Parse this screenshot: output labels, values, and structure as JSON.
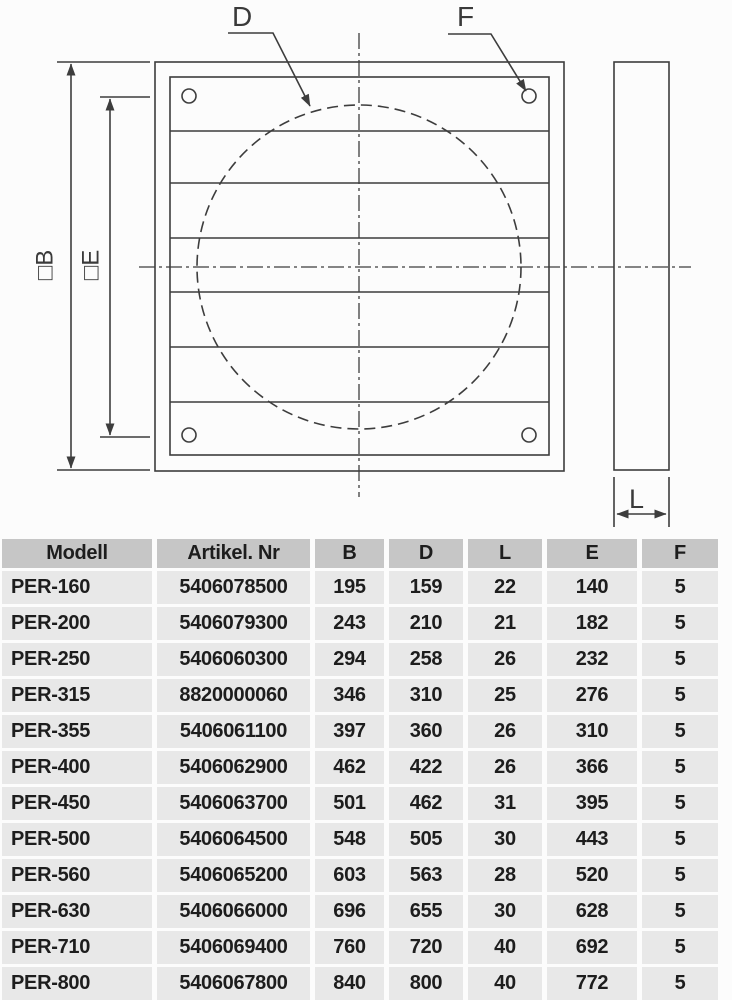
{
  "diagram": {
    "labels": {
      "d": "D",
      "f": "F",
      "l": "L",
      "b": "□B",
      "e": "□E"
    },
    "colors": {
      "line": "#3d3d3d"
    }
  },
  "table": {
    "colors": {
      "header_bg": "#c6c6c6",
      "row_bg": "#e8e8e8",
      "text": "#1d1d1d"
    },
    "columns": [
      "Modell",
      "Artikel. Nr",
      "B",
      "D",
      "L",
      "E",
      "F"
    ],
    "rows": [
      [
        "PER-160",
        "5406078500",
        "195",
        "159",
        "22",
        "140",
        "5"
      ],
      [
        "PER-200",
        "5406079300",
        "243",
        "210",
        "21",
        "182",
        "5"
      ],
      [
        "PER-250",
        "5406060300",
        "294",
        "258",
        "26",
        "232",
        "5"
      ],
      [
        "PER-315",
        "8820000060",
        "346",
        "310",
        "25",
        "276",
        "5"
      ],
      [
        "PER-355",
        "5406061100",
        "397",
        "360",
        "26",
        "310",
        "5"
      ],
      [
        "PER-400",
        "5406062900",
        "462",
        "422",
        "26",
        "366",
        "5"
      ],
      [
        "PER-450",
        "5406063700",
        "501",
        "462",
        "31",
        "395",
        "5"
      ],
      [
        "PER-500",
        "5406064500",
        "548",
        "505",
        "30",
        "443",
        "5"
      ],
      [
        "PER-560",
        "5406065200",
        "603",
        "563",
        "28",
        "520",
        "5"
      ],
      [
        "PER-630",
        "5406066000",
        "696",
        "655",
        "30",
        "628",
        "5"
      ],
      [
        "PER-710",
        "5406069400",
        "760",
        "720",
        "40",
        "692",
        "5"
      ],
      [
        "PER-800",
        "5406067800",
        "840",
        "800",
        "40",
        "772",
        "5"
      ]
    ]
  }
}
